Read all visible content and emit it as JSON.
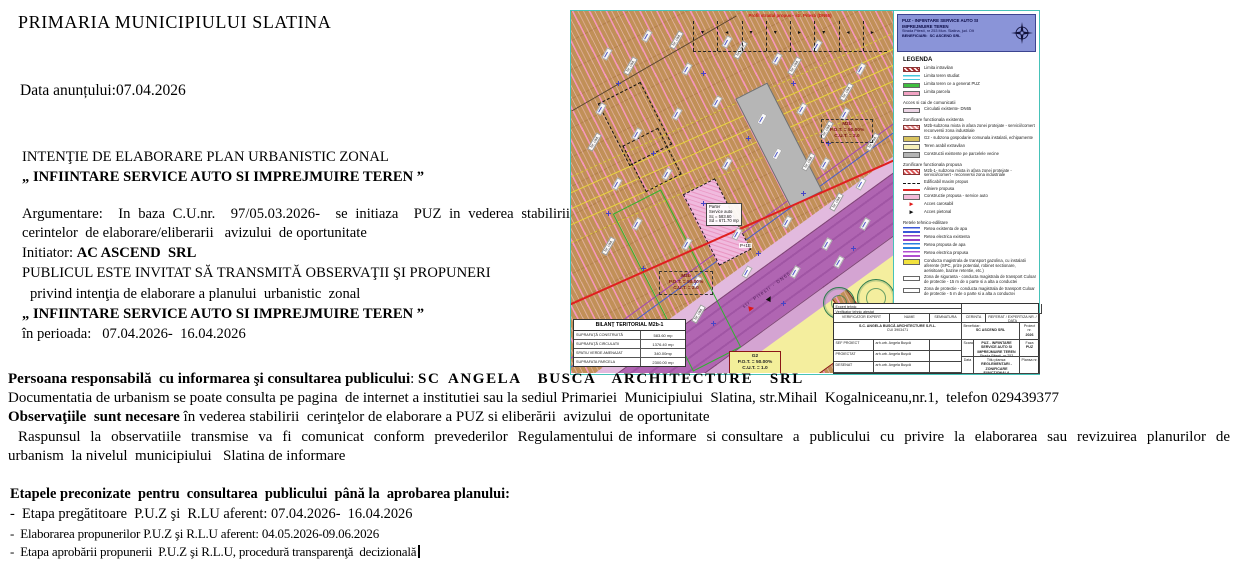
{
  "header": {
    "org": "PRIMARIA MUNICIPIULUI SLATINA",
    "date_line": "Data anunțului:07.04.2026"
  },
  "notice": {
    "line1": "INTENŢIE DE ELABORARE PLAN URBANISTIC ZONAL",
    "line2": "„ INFIINTARE SERVICE AUTO SI IMPREJMUIRE TEREN ”",
    "argumentare": "Argumentare:  In baza C.U.nr.  97/05.03.2026-  se initiaza  PUZ in vederea stabilirii cerintelor  de elaborare/eliberarii   avizului  de oportunitate",
    "initiator_label": "Initiator: ",
    "initiator_value": "AC ASCEND  SRL",
    "public_line": "PUBLICUL ESTE INVITAT SĂ TRANSMITĂ OBSERVAŢII ŞI PROPUNERI",
    "public_line2": "privind intenţia de elaborare a planului  urbanistic  zonal",
    "title_repeat": "„ INFIINTARE SERVICE AUTO SI IMPREJMUIRE TEREN ”",
    "period": "în perioada:   07.04.2026-  16.04.2026"
  },
  "footer": {
    "persoana_label": "Persoana responsabilă  cu informarea şi consultarea publicului",
    "persoana_value": "SC ANGELA  BUSCA  ARCHITECTURE  SRL",
    "documentatia": "Documentatia de urbanism se poate consulta pe pagina  de internet a institutiei sau la sediul Primariei  Municipiului  Slatina, str.Mihail  Kogalniceanu,nr.1,  telefon 029439377",
    "observatii_label": "Observaţiile  sunt necesare",
    "observatii_rest": " în vederea stabilirii  cerinţelor de elaborare a PUZ si eliberării  avizului  de oportunitate",
    "raspunsul": "Raspunsul  la  observatiile  transmise  va  fi  comunicat  conform  prevederilor  Regulamentului de informare  si consultare  a  publicului  cu  privire  la  elaborarea  sau  revizuirea  planurilor  de urbanism  la nivelul  municipiului   Slatina de informare"
  },
  "etape": {
    "title": "Etapele preconizate  pentru  consultarea  publicului  până la  aprobarea planului:",
    "items": [
      "-  Etapa pregătitoare  P.U.Z şi  R.LU aferent: 07.04.2026-  16.04.2026",
      "-  Elaborarea propunerilor P.U.Z şi R.L.U aferent: 04.05.2026-09.06.2026",
      "-  Etapa aprobării propunerii  P.U.Z şi R.L.U, procedură transparenţă  decizională"
    ]
  },
  "map": {
    "profil_label": "Profil stradal propus  -  str. Pitesti (DN65)",
    "road_label": "str. Pitesti - DN65",
    "parcel_label": "Nr. cad.",
    "building_label": "Parter\nService auto\nSc = 583.60\nSd = 671.70 mp",
    "building_tag": "P+1E",
    "zone_box1": "M2b\nP.O.T. = 50.00%\nC.U.T. = 2.0",
    "zone_box2": "M2b\nP.O.T. = 50.00%\nC.U.T. = 2.0",
    "zone_box_g2": "G2\nP.O.T. = 50.00%\nC.U.T. = 1.0",
    "bilant": {
      "title": "BILANŢ TERITORIAL M2b-1",
      "rows": [
        [
          "SUPRAFAŢĂ CONSTRUITĂ",
          "583.60 mp"
        ],
        [
          "SUPRAFAŢĂ CIRCULATII",
          "1376.40 mp"
        ],
        [
          "SPATIU VERDE AMENAJAT",
          "340.00mp"
        ],
        [
          "SUPRAFATA PARCELA",
          "2300.00 mp"
        ]
      ]
    },
    "legend": {
      "header_title": "PUZ - INFIINTARE SERVICE AUTO SI IMPREJMUIRE TEREN",
      "header_address": "Strada Pitesti, nr 253 Mun. Slatina, jud. Olt",
      "header_beneficiary": "BENEFICIARI:  SC ASCEND SRL",
      "title": "LEGENDA",
      "sections": [
        {
          "heading": "",
          "items": [
            {
              "kind": "hatch",
              "color": "#a42323",
              "label": "Limita intravilan"
            },
            {
              "kind": "lines",
              "color": "#46c8dc",
              "label": "Limita teren studiat"
            },
            {
              "kind": "solid",
              "color": "#3fbf3f",
              "label": "Limita teren ce a generat PUZ"
            },
            {
              "kind": "solid",
              "color": "#f2a3c3",
              "label": "Limita parcela"
            }
          ]
        },
        {
          "heading": "Acces si cai de comunicatii",
          "items": [
            {
              "kind": "solid",
              "color": "#ecd4e4",
              "label": "Circulatii existente- DN65"
            }
          ]
        },
        {
          "heading": "Zonificare functionala existenta",
          "items": [
            {
              "kind": "hatch",
              "color": "#e07f7f",
              "label": "M2b-subzona mixta in afara zonei protejate  - servicii/comert reconversii zona industriale"
            },
            {
              "kind": "solid",
              "color": "#d9c35f",
              "label": "G2 - subzona gospodarie comunala instalatii, echipamente"
            },
            {
              "kind": "solid",
              "color": "#f6f0b9",
              "label": "Teren arabil extravilan"
            },
            {
              "kind": "solid",
              "color": "#b5b5b5",
              "label": "Constructii existente pe parcelele vecine"
            }
          ]
        },
        {
          "heading": "Zonificare functionala propusa",
          "items": [
            {
              "kind": "hatch",
              "color": "#d94f4f",
              "label": "M2b-1- subzona mixta in afara zonei protejate - servicii/comert - reconversii zona industriale"
            },
            {
              "kind": "dash",
              "color": "#111111",
              "label": "Edificabil maxim propus"
            },
            {
              "kind": "line",
              "color": "#e02222",
              "label": "Aliniere propusa"
            },
            {
              "kind": "solid",
              "color": "#f3b9d8",
              "label": "Constructie propusa  -  service auto"
            },
            {
              "kind": "arrow",
              "color": "#e01818",
              "label": "Acces carosabil"
            },
            {
              "kind": "arrow",
              "color": "#111111",
              "label": "Acces pietonal"
            }
          ]
        },
        {
          "heading": "Retele tehnico-edilitare",
          "items": [
            {
              "kind": "lines",
              "color": "#3b57d8",
              "label": "Retea existenta de apa"
            },
            {
              "kind": "lines",
              "color": "#9b3fc0",
              "label": "Retea electrica existenta"
            },
            {
              "kind": "lines",
              "color": "#2a7fe0",
              "label": "Retea propusa de apa"
            },
            {
              "kind": "lines",
              "color": "#b04fd0",
              "label": "Retea electrica propusa"
            }
          ]
        },
        {
          "heading": "",
          "items": [
            {
              "kind": "solid",
              "color": "#f2e23e",
              "label": "Conducta magistrala de transport gazolina, cu instalatii aferente (SPC, prize potential, robinet sectionare, aerisitoare, bazine retentie, etc.)"
            },
            {
              "kind": "white",
              "color": "#ffffff",
              "label": "Zona de siguranta  -  conducta magistrala de transport Culoar de protectie  - 15 m de o parte si a alta a conductei"
            },
            {
              "kind": "white",
              "color": "#ffffff",
              "label": "Zona de protectie  -  conducta magistrala de transport Culoar de protectie  - 5 m de o parte si a alta a conductei"
            }
          ]
        }
      ]
    },
    "titleblock": {
      "top_row1": "Expert tehnic",
      "top_row2": "Verificator tehnic atestat",
      "col_verificator": "VERIFICATOR EXPERT",
      "col_nume": "NUME",
      "col_semnatura": "SEMNATURA",
      "col_cerinta": "CERINTA",
      "col_referat": "REFERAT / EXPERTIZA NR. / DATA",
      "company": "S.C. ANGELA BUSCĂ ARCHITECTURE  S.R.L.",
      "company_cui": "CUI 3903471",
      "beneficiar_label": "Beneficiar:",
      "beneficiar": "SC ASCEND SRL",
      "roles": [
        [
          "SEF PROIECT",
          "arh.urb. Angela Buşcă"
        ],
        [
          "PROIECTAT",
          "arh.urb. Angela Buşcă"
        ],
        [
          "DESENAT",
          "arh.urb. Angela Buşcă"
        ]
      ],
      "scara_label": "Scara",
      "data_label": "Data",
      "proiect_label": "Proiect:",
      "proiect": "PUZ - INFIINTARE SERVICE AUTO SI IMPREJMUIRE TEREN",
      "proiect_addr": "Strada Pitesti, nr 253 Mun. Slatina, jud. Olt",
      "proiect_nr_label": "Proiect nr.",
      "anul": "2026",
      "faza_label": "Faza",
      "faza": "PUZ",
      "plansa_label": "Titlu plansa:",
      "plansa": "REGLEMENTARI - ZONIFICARE FUNCTIONALA",
      "plansa_nr_label": "Plansa nr."
    }
  }
}
